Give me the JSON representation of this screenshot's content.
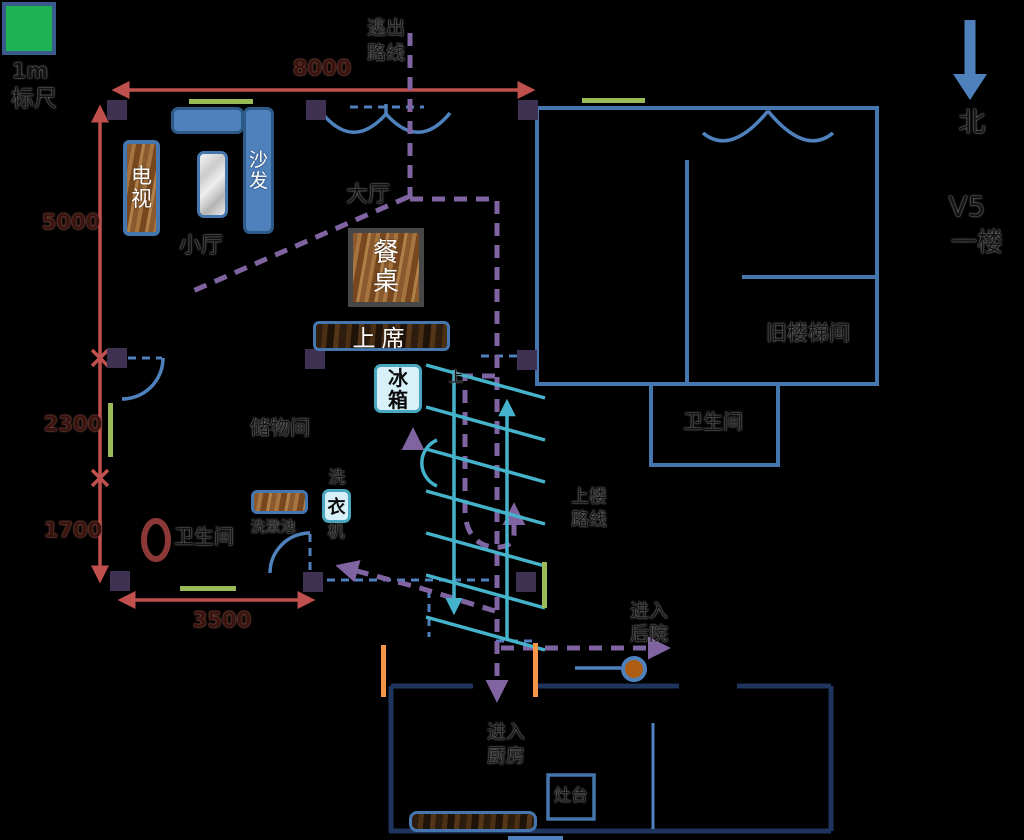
{
  "legend": {
    "scale_value": "1m",
    "scale_label": "标尺"
  },
  "compass": {
    "north_label": "北",
    "version_label": "V5",
    "floor_label": "一楼"
  },
  "dimensions": {
    "top": "8000",
    "left_upper": "5000",
    "left_middle": "2300",
    "left_lower": "1700",
    "bottom": "3500"
  },
  "routes": {
    "escape_l1": "逃出",
    "escape_l2": "路线",
    "upstairs_l1": "上楼",
    "upstairs_l2": "路线",
    "kitchen_l1": "进入",
    "kitchen_l2": "厨房",
    "backyard_l1": "进入",
    "backyard_l2": "后院",
    "stairs_up_mark": "上"
  },
  "rooms": {
    "main_hall": "大厅",
    "small_hall": "小厅",
    "storage_room": "储物间",
    "bathroom_left": "卫生间",
    "bathroom_right": "卫生间",
    "old_stairwell": "旧楼梯间"
  },
  "furniture": {
    "tv": "电视",
    "sofa": "沙发",
    "dining_table": "餐桌",
    "head_seat": "上席",
    "fridge": "冰箱",
    "washer_char_top": "洗",
    "washer_char_mid": "衣",
    "washer_char_bottom": "机",
    "wash_basin": "洗漱池",
    "stove": "灶台"
  },
  "colors": {
    "dimension_red": "#C0504D",
    "route_purple": "#8064A2",
    "door_blue": "#4F81BD",
    "wall_blue": "#4576AD",
    "kitchen_navy": "#1E355E",
    "stairs_cyan": "#45B3CB",
    "window_green": "#9BBB59",
    "column_purple": "#3F3151",
    "scale_green": "#1FB254",
    "jamb_orange": "#F79646",
    "well_brown": "#AC5D13",
    "toilet_red": "#8C3836"
  }
}
